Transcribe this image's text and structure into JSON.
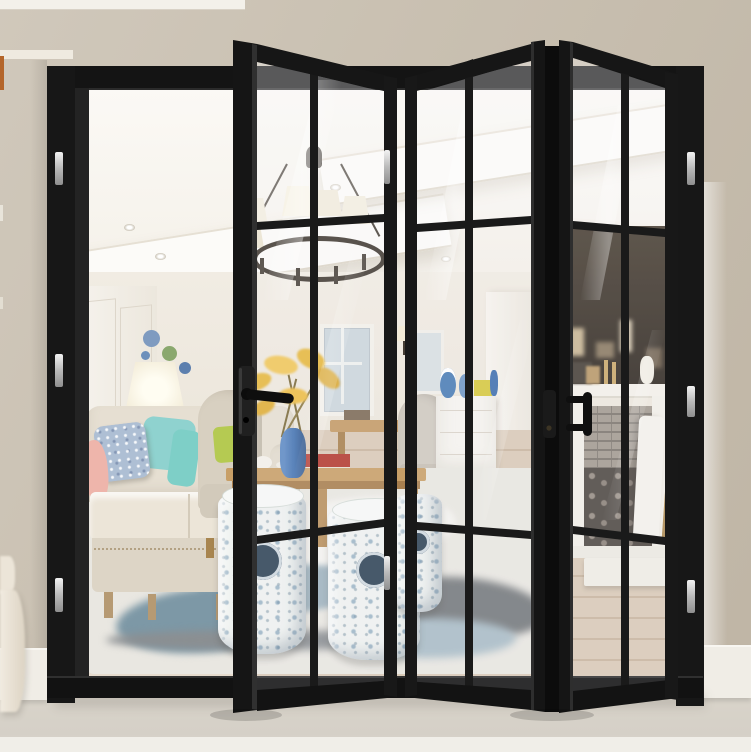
{
  "image": {
    "kind": "product-photograph",
    "description": "Black aluminium bi-fold French door, three glazed grille panels partly folded open beside an open bay, revealing a bright living room with an iron ring chandelier, cream sofa with blue teal and pink cushions, table lamp, wood coffee table with yellow flowers in a blue vase, blue-and-white porcelain garden stools, abstract blue rug, white sideboard and a white fireplace stacked with firewood",
    "width_px": 751,
    "height_px": 752
  },
  "door": {
    "type": "bi-fold glazed patio door",
    "frame_finish": "matte black aluminium",
    "folding_panel_count": 3,
    "lites_per_panel": 6,
    "open_bays": 1,
    "hardware": [
      "lever handle",
      "keyhole escutcheon",
      "D-pull handle",
      "stainless barrel hinges"
    ],
    "hinge_finish": "stainless steel"
  },
  "room": {
    "ceiling_features": [
      "white coffered bulkheads",
      "recessed downlights",
      "wrought-iron ring chandelier with cream shades"
    ],
    "furniture": [
      "cream fabric sofa",
      "beige wing armchair",
      "grey dining chair",
      "wood coffee table",
      "white sideboard",
      "porcelain garden stools",
      "white fireplace with brick firebox and log store",
      "wood dining table"
    ],
    "decor": [
      "blue and green wall plates",
      "table lamp with dark urn base",
      "yellow forsythia in blue vase",
      "blue speckled cushion",
      "teal cushion",
      "pink cushion",
      "lime cushion",
      "blue-and-white jars",
      "abstract blue rug",
      "oak plank flooring",
      "cream wall sconces",
      "leaning white panel",
      "brass fire poker"
    ]
  },
  "colors": {
    "frame_black": "#161616",
    "wall_beige": "#c9c0b1",
    "exterior_floor": "#d9d4ca",
    "baseboard_white": "#f0ede6",
    "interior_white": "#f6f3ed",
    "wood_floor": "#d7c7b3",
    "rug_blue": "#9cb0bb",
    "sofa_cream": "#e6dfd2",
    "cushion_teal": "#7ecfc7",
    "cushion_pink": "#eeb5ab",
    "cushion_blue": "#aebfd4",
    "cushion_lime": "#b5ca52",
    "vase_blue": "#4372b0",
    "flowers_yellow": "#e6b83e",
    "stool_blue": "#5d86a6",
    "lamp_base": "#333a52",
    "hinge_silver": "#d6d6d6"
  }
}
